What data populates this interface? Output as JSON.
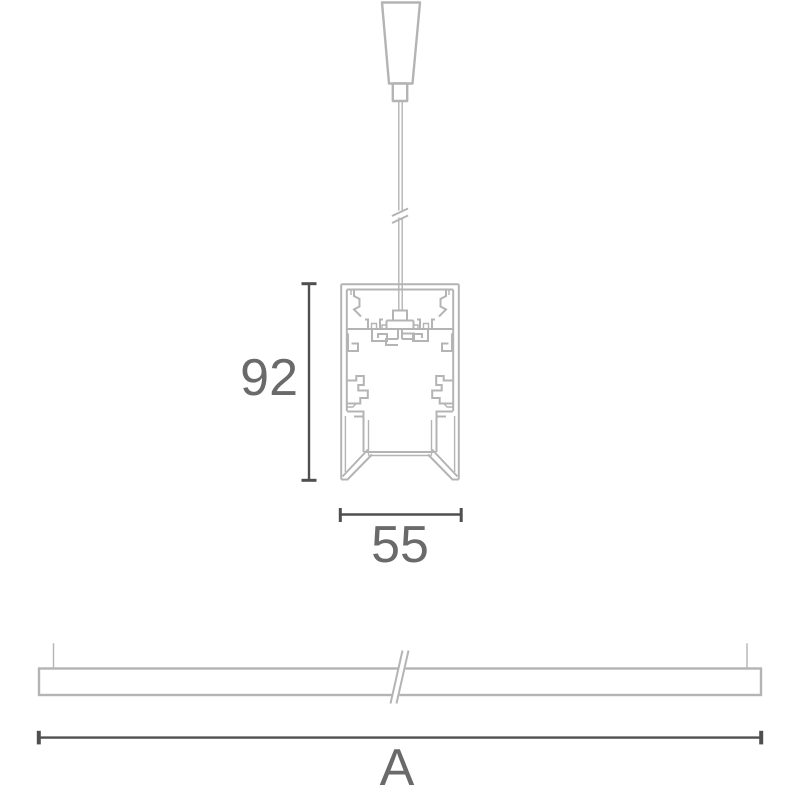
{
  "drawing": {
    "labels": {
      "profile_height": "92",
      "profile_width": "55",
      "luminaire_length": "A"
    },
    "colors": {
      "background": "#ffffff",
      "outline": "#b4b4b4",
      "dimension": "#4f4f4f",
      "label": "#6a6a6a"
    }
  }
}
